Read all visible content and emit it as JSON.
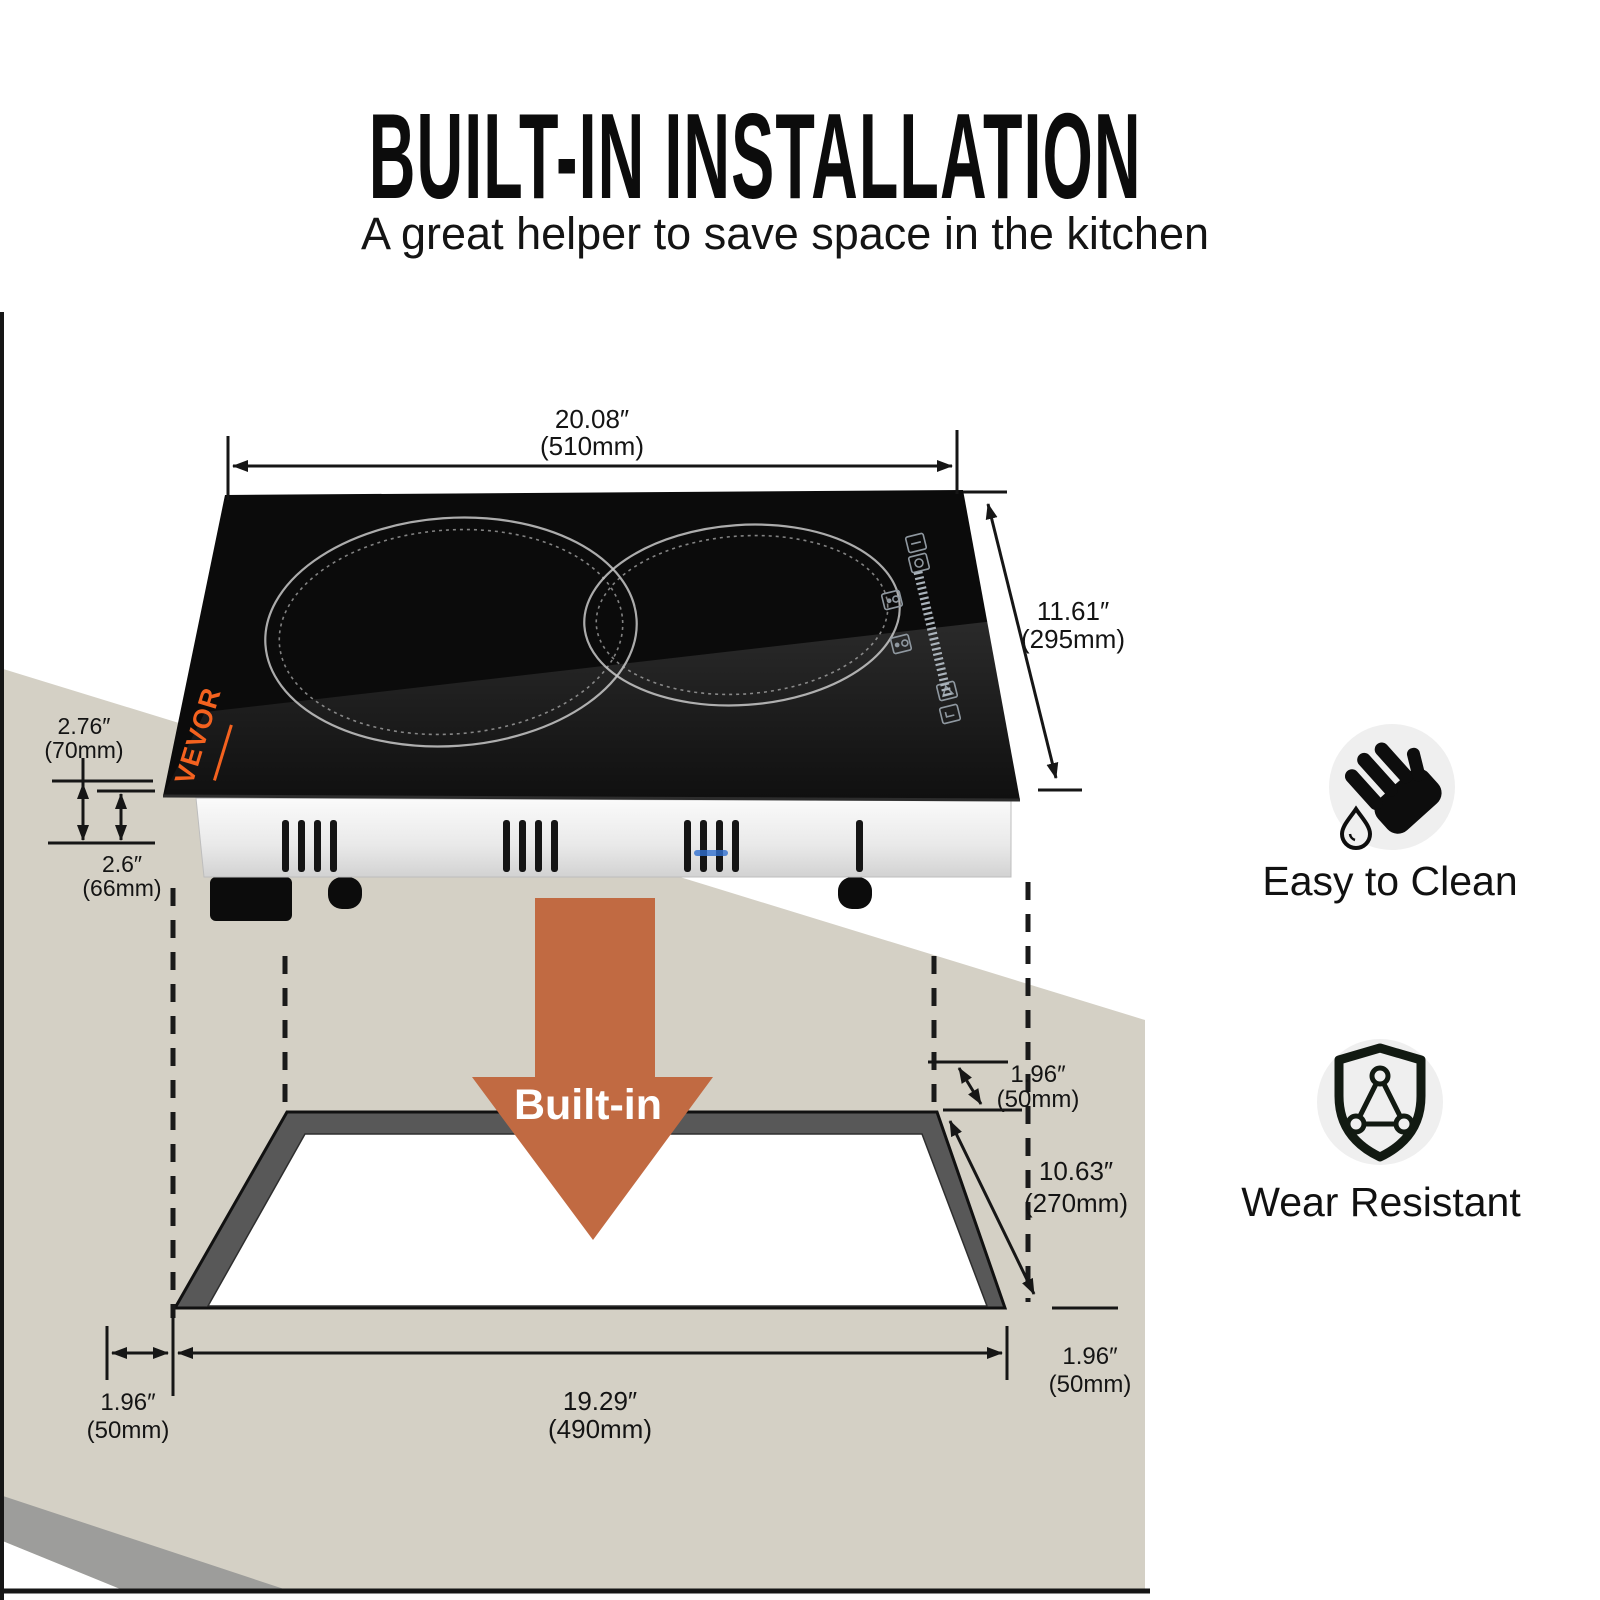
{
  "header": {
    "title": "BUILT-IN INSTALLATION",
    "subtitle": "A great helper to save space in the kitchen"
  },
  "cooktop": {
    "brand": "VEVOR",
    "burner_count": 2,
    "control_icons": [
      "minus-icon",
      "power-icon",
      "timer-icon",
      "function-icon",
      "warning-icon",
      "enter-icon",
      "level-slider-ticks"
    ]
  },
  "builtin_arrow": {
    "label": "Built-in"
  },
  "dims": {
    "width": {
      "in": "20.08″",
      "mm": "(510mm)"
    },
    "depth": {
      "in": "11.61″",
      "mm": "(295mm)"
    },
    "h_total": {
      "in": "2.76″",
      "mm": "(70mm)"
    },
    "h_body": {
      "in": "2.6″",
      "mm": "(66mm)"
    },
    "cut_back": {
      "in": "1.96″",
      "mm": "(50mm)"
    },
    "cut_depth": {
      "in": "10.63″",
      "mm": "(270mm)"
    },
    "cut_left": {
      "in": "1.96″",
      "mm": "(50mm)"
    },
    "cut_width": {
      "in": "19.29″",
      "mm": "(490mm)"
    },
    "cut_right": {
      "in": "1.96″",
      "mm": "(50mm)"
    }
  },
  "features": [
    {
      "label": "Easy to Clean",
      "icon": "hand-water-icon"
    },
    {
      "label": "Wear Resistant",
      "icon": "shield-triangle-icon"
    }
  ],
  "colors": {
    "countertop_beige": "#d4d0c5",
    "counter_edge_gray": "#9d9d9b",
    "cutout_gray": "#585858",
    "arrow_orange": "#c16a42",
    "brand_orange": "#f4621f",
    "line_black": "#161616",
    "glass_black": "#0b0b0b",
    "icon_circle_bg": "#efefef"
  }
}
